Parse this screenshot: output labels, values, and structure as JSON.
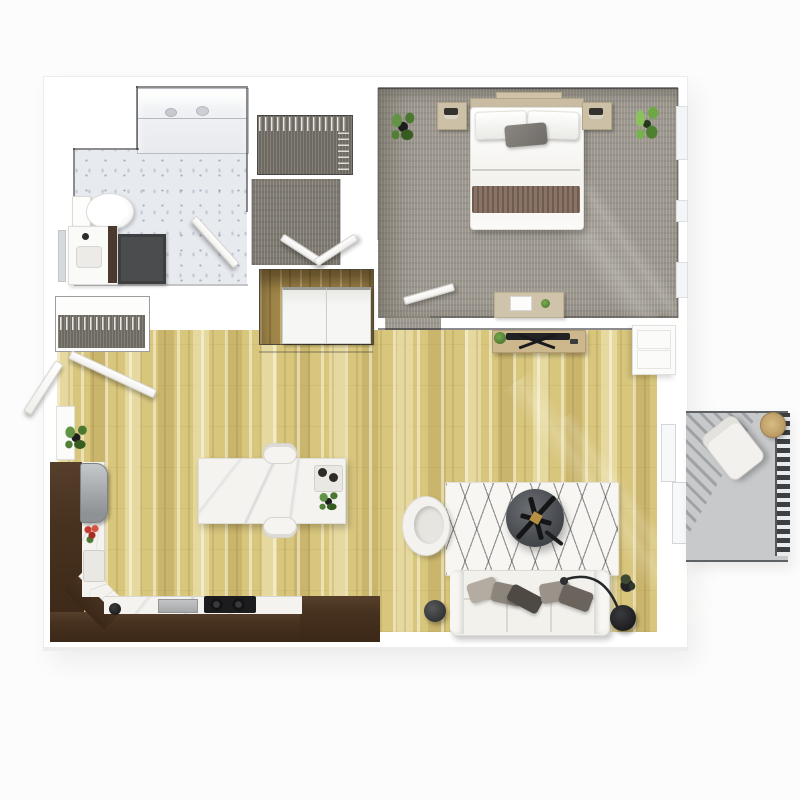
{
  "scene": {
    "type": "floor-plan-3d-render",
    "view": "top-down",
    "description": "One-bedroom / one-bath apartment floor plan rendered in 3D with furniture, wood-look living area, carpeted bedroom and closets, tiled bathroom and a private balcony"
  },
  "rooms": [
    {
      "name": "bathroom",
      "floor": "speckled-tile"
    },
    {
      "name": "walk-in-closet",
      "floor": "dark-carpet"
    },
    {
      "name": "closet-hall",
      "floor": "carpet"
    },
    {
      "name": "coat-closet",
      "floor": "dark-carpet"
    },
    {
      "name": "laundry-closet",
      "floor": "dark-wood"
    },
    {
      "name": "bedroom",
      "floor": "carpet"
    },
    {
      "name": "living-dining",
      "floor": "light-wood-plank"
    },
    {
      "name": "kitchen",
      "floor": "light-wood-plank"
    },
    {
      "name": "balcony",
      "floor": "concrete"
    }
  ],
  "furniture": {
    "bathroom": [
      "glass-shower",
      "toilet",
      "vanity-with-sink",
      "bath-mat",
      "wall-mirror"
    ],
    "closets": [
      "hanging-clothes-rod",
      "double-doors",
      "washer",
      "dryer"
    ],
    "bedroom": [
      "bed-with-white-duvet",
      "brown-throw-blanket",
      "gray-accent-pillow",
      "headboard",
      "wall-shelf",
      "nightstand-left",
      "nightstand-right",
      "potted-plant-left",
      "potted-plant-right",
      "desk-with-laptop",
      "door-leaf"
    ],
    "living": [
      "tv-console",
      "tv",
      "white-storage-cabinet",
      "diamond-pattern-rug",
      "round-coffee-table",
      "accent-chair",
      "three-seat-sofa",
      "throw-pillows",
      "arc-floor-lamp",
      "round-side-table",
      "plant-stand"
    ],
    "kitchen": [
      "l-shaped-espresso-counter",
      "refrigerator",
      "kitchen-sink",
      "red-flowers",
      "cutting-board",
      "cooktop-with-burners",
      "utensil-crock",
      "marble-island",
      "bar-stool-top",
      "bar-stool-bottom",
      "serving-tray-with-cups",
      "island-plant",
      "pantry-cabinet",
      "entry-plant",
      "entry-door-leaves"
    ],
    "balcony": [
      "lounge-chair",
      "round-wood-table",
      "metal-railing",
      "sliding-door-panels"
    ]
  },
  "colors": {
    "page_bg": "#fcfcfc",
    "wall": "#ffffff",
    "wall_edge": "#ececec",
    "line": "#36363a",
    "tile": "#e7eaef",
    "carpet_dark": "#6e6a62",
    "carpet_mid": "#7d7970",
    "carpet_light": "#9c978e",
    "wood": "#d8c67d",
    "laundry_wood": "#a1874a",
    "espresso": "#47311f",
    "marble": "#f4f3f0",
    "stainless": "#a9adaf",
    "rug": "#f7f6f2",
    "sofa": "#f2f1ec",
    "tan": "#ccc0a6",
    "blanket": "#8a7364",
    "plant": "#5b8a3c",
    "plant_bright": "#76ab4a",
    "dark": "#242527",
    "balcony": "#c7c9cb",
    "railing": "#3d4043",
    "red_accent": "#c23b2e",
    "gold": "#b79043"
  }
}
